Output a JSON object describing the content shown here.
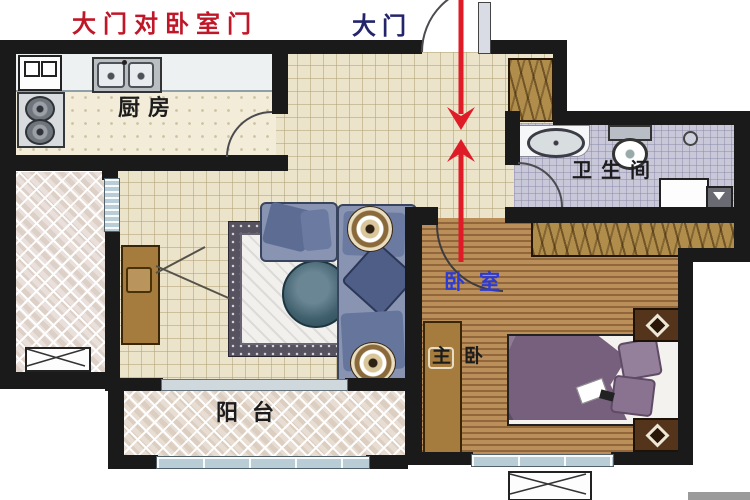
{
  "annotations": {
    "warning": "大门对卧室门",
    "entrance_door": "大门",
    "bedroom_pointer": "卧室"
  },
  "rooms": {
    "kitchen": "厨房",
    "bathroom": "卫生间",
    "master_bedroom": "主卧",
    "balcony": "阳台"
  },
  "colors": {
    "warning_text": "#c01728",
    "entrance_text": "#23246b",
    "bedroom_pointer_text": "#2b3bd6",
    "room_label_text": "#1c1c1c",
    "arrow": "#e01b28",
    "walls": "#1a1a1a",
    "tile_floor": "#ebe3ca",
    "kitchen_floor": "#f2ecd9",
    "bathroom_floor": "#c9c8d9",
    "wood_floor": "#b98c57",
    "balcony_floor": "#e7ddd2",
    "sofa": "#8894b1",
    "bed_blanket": "#77607e",
    "furniture_wood": "#a57c3e",
    "window": "#b9cdd6"
  },
  "furniture_icons": [
    "refrigerator",
    "gas-stove",
    "kitchen-sink",
    "kitchen-counter",
    "shoe-cabinet",
    "washbasin",
    "toilet",
    "floor-drain",
    "washing-machine",
    "wardrobe",
    "double-bed",
    "pillow",
    "nightstand",
    "dresser",
    "tv-cabinet",
    "sofa",
    "area-rug",
    "coffee-table",
    "side-table",
    "air-conditioner",
    "window",
    "door-swing"
  ]
}
